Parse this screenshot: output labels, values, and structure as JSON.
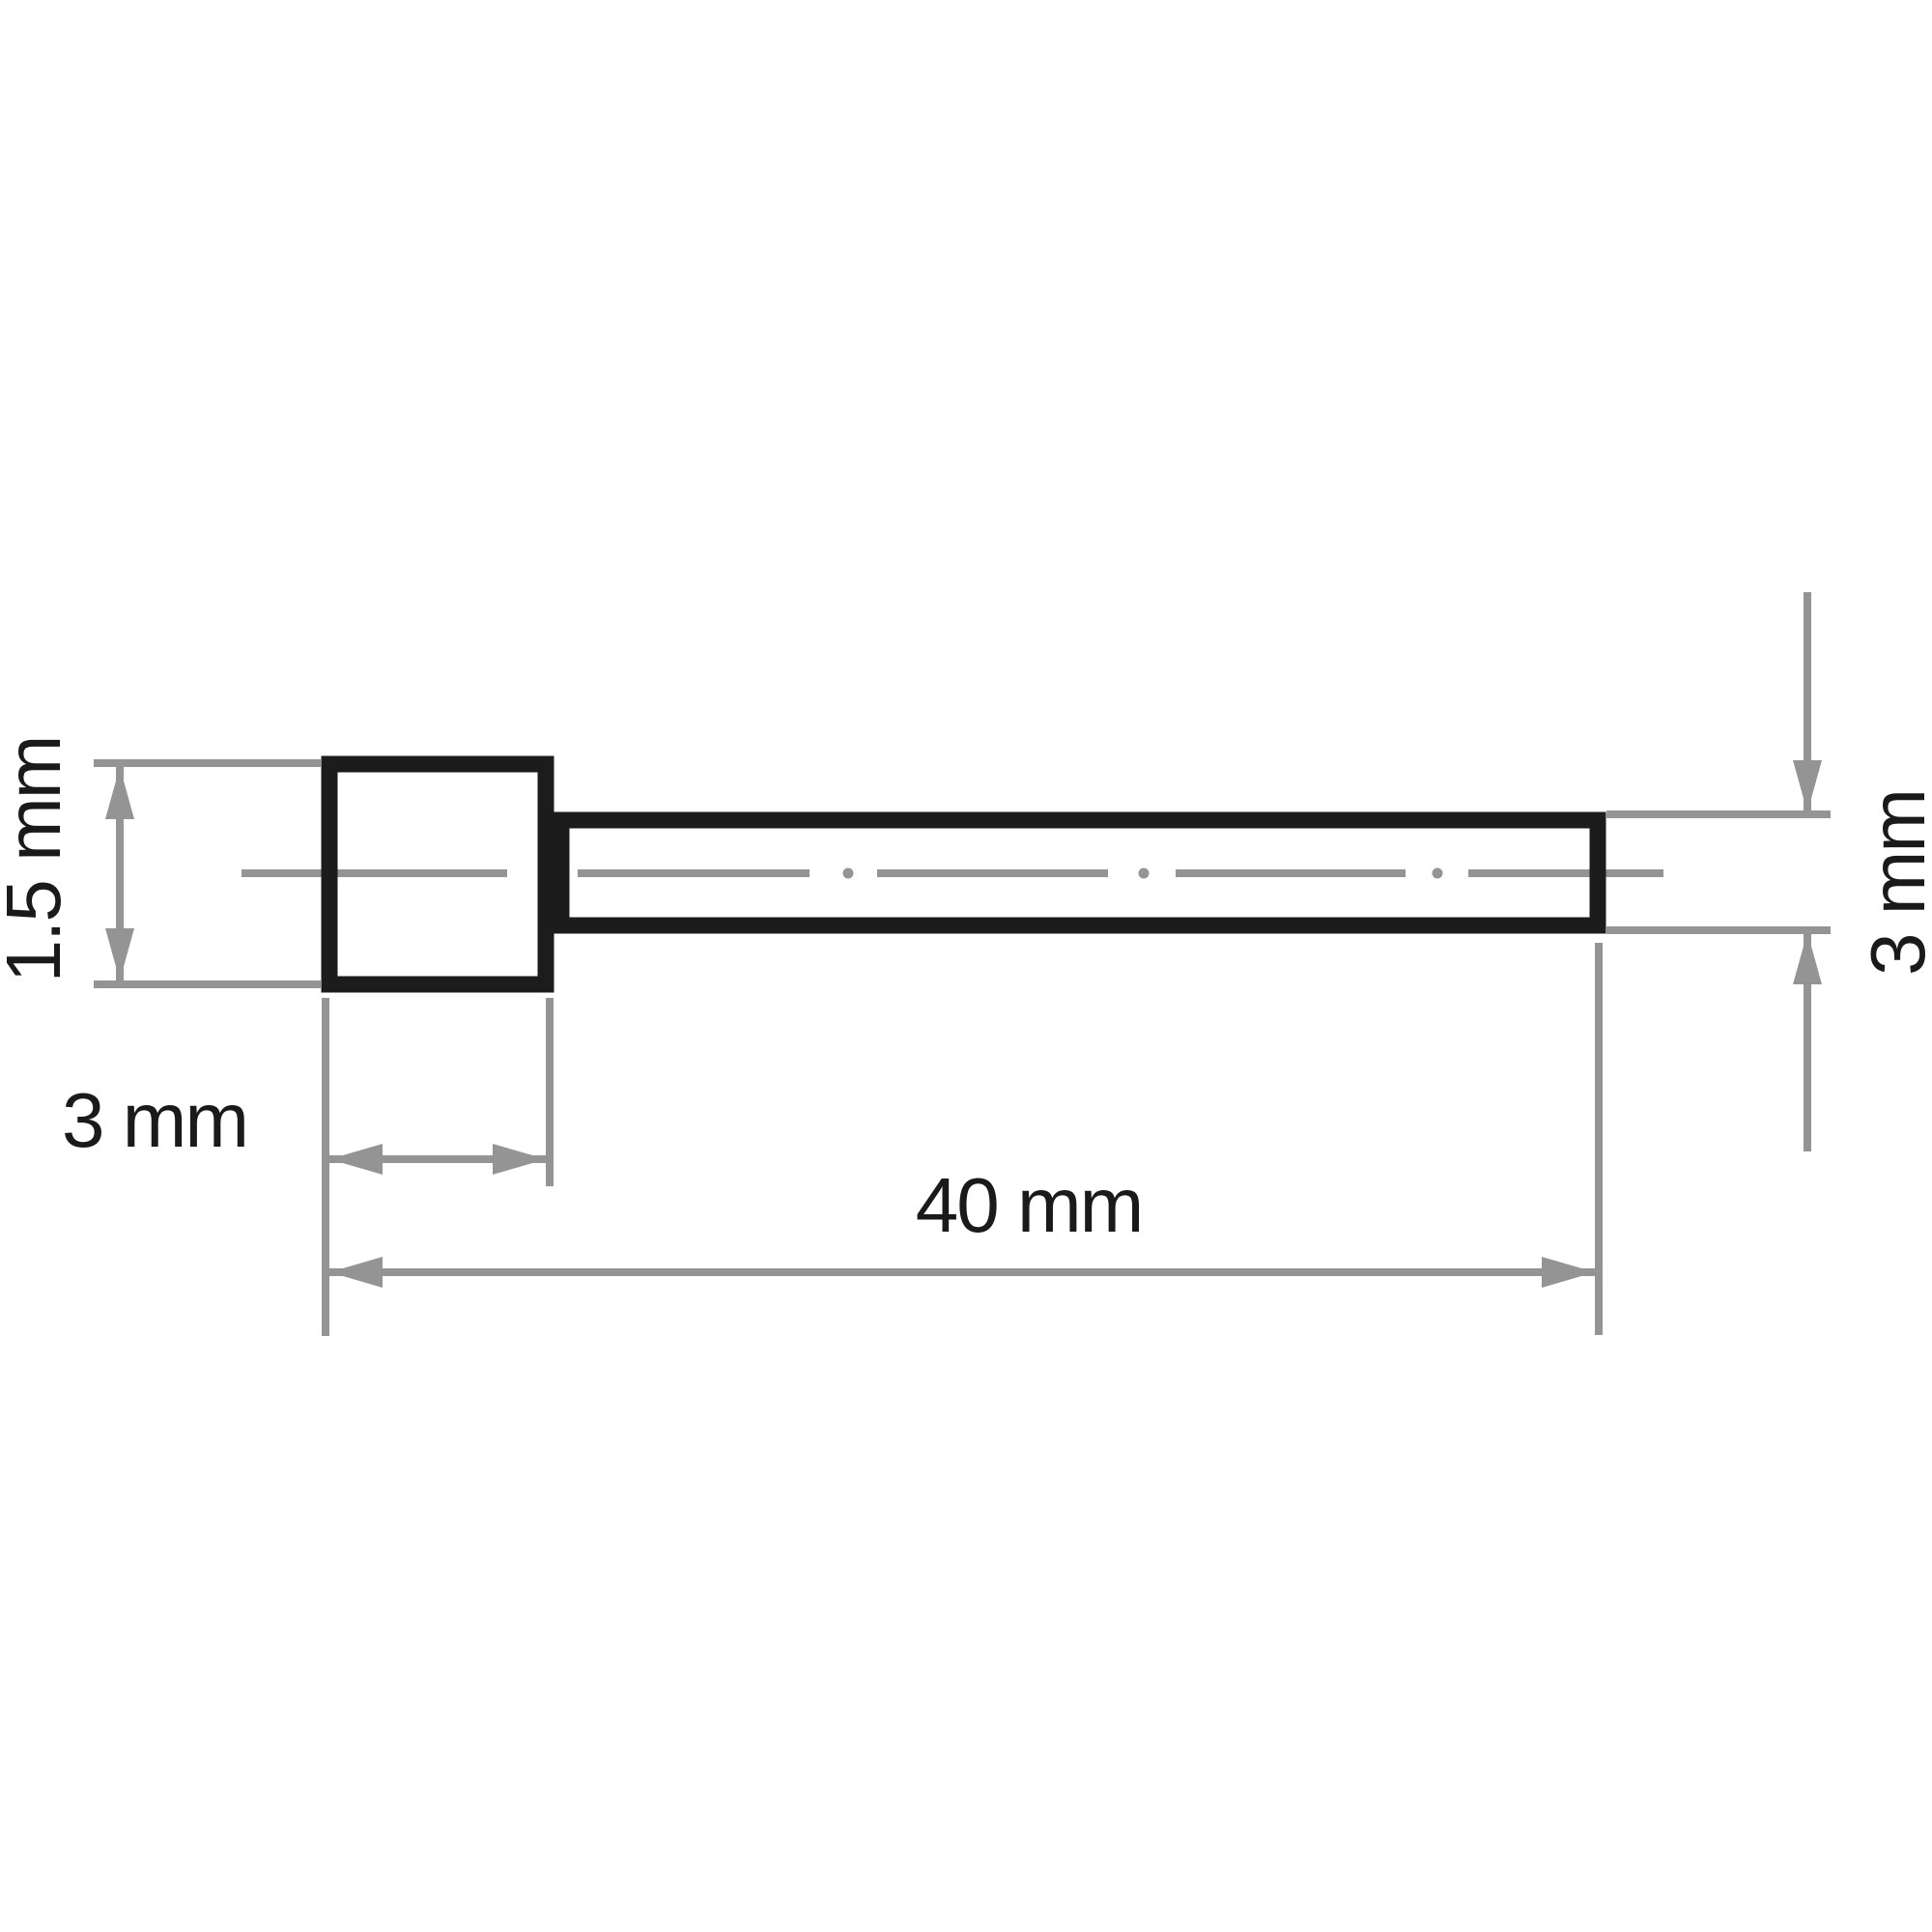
{
  "labels": {
    "head_height": "1.5 mm",
    "head_width": "3 mm",
    "shank_length": "40 mm",
    "shank_diameter": "3 mm"
  },
  "colors": {
    "outline": "#1c1c1c",
    "dimension": "#949494",
    "text": "#1a1a1a",
    "background": "#ffffff"
  }
}
